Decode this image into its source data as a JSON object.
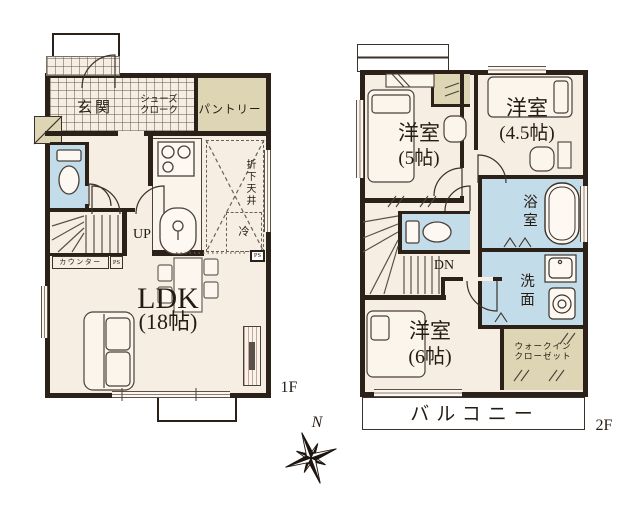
{
  "colors": {
    "wall": "#2b2118",
    "floor": "#f7eee3",
    "wet": "#c2dcea",
    "storage": "#ded5b4"
  },
  "floor1": {
    "floor_label": "1F",
    "entrance": "玄関",
    "shoe_closet": "シューズ\nクローク",
    "pantry": "パントリー",
    "stairs_up": "UP",
    "counter": "カウンター",
    "pipe_space_1": "PS",
    "pipe_space_2": "PS",
    "ldk_name": "LDK",
    "ldk_size": "(18帖)",
    "dropped_ceiling": "折下天井",
    "refrigerator": "冷"
  },
  "floor2": {
    "floor_label": "2F",
    "bedroom5_name": "洋室",
    "bedroom5_size": "(5帖)",
    "bedroom45_name": "洋室",
    "bedroom45_size": "(4.5帖)",
    "bathroom": "浴室",
    "washroom": "洗面",
    "stairs_down": "DN",
    "bedroom6_name": "洋室",
    "bedroom6_size": "(6帖)",
    "walk_in_closet": "ウォークイン\nクローゼット",
    "balcony": "バルコニー"
  },
  "compass": {
    "north": "N"
  }
}
